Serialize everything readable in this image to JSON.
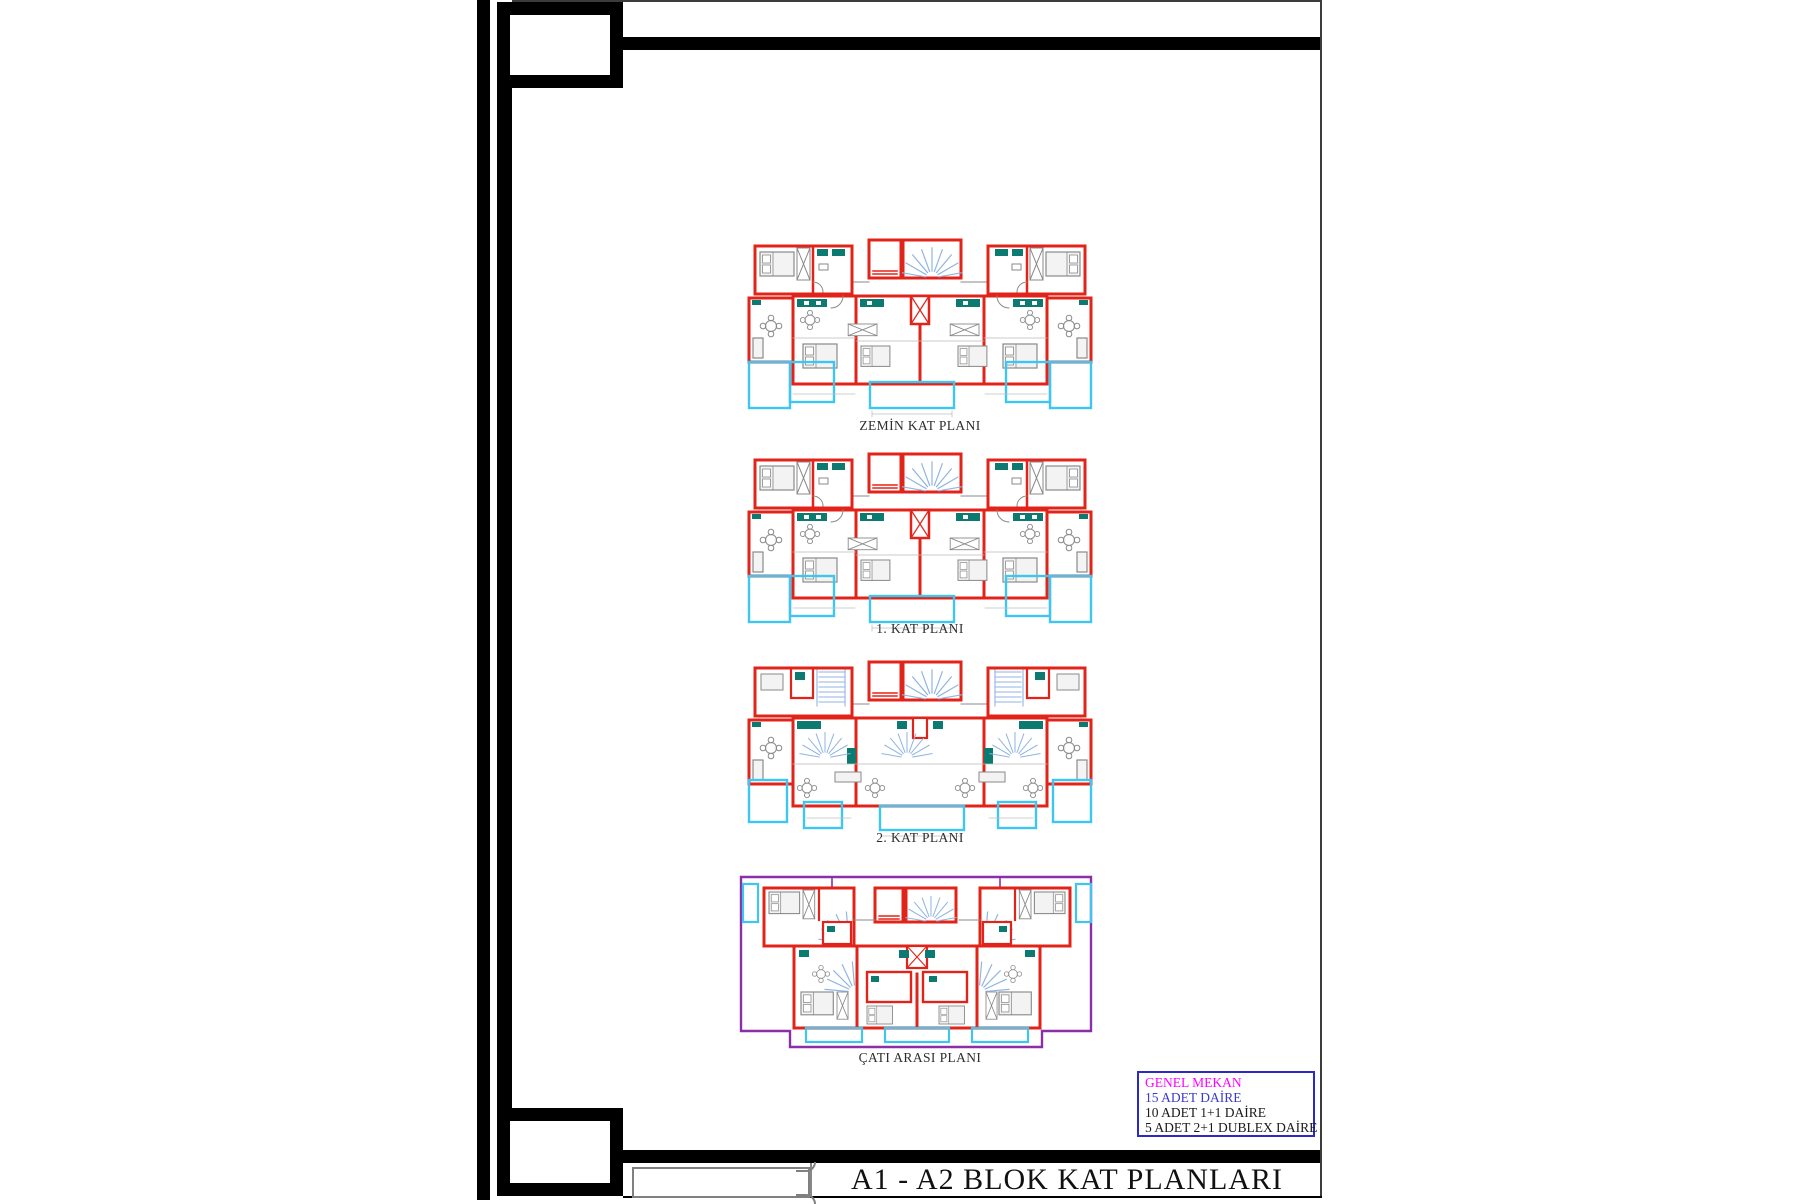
{
  "sheet": {
    "title": "A1 - A2 BLOK KAT PLANLARI"
  },
  "plans": [
    {
      "label": "ZEMİN KAT PLANI"
    },
    {
      "label": "1. KAT PLANI"
    },
    {
      "label": "2. KAT PLANI"
    },
    {
      "label": "ÇATI ARASI PLANI"
    }
  ],
  "legend": {
    "title": "GENEL MEKAN",
    "title_color": "#ff00ff",
    "items": [
      {
        "text": "15 ADET DAİRE",
        "color": "#3a3ad0"
      },
      {
        "text": "10 ADET 1+1 DAİRE",
        "color": "#1a1a1a"
      },
      {
        "text": "5 ADET 2+1 DUBLEX DAİRE",
        "color": "#1a1a1a"
      }
    ]
  },
  "colors": {
    "wall_red": "#e2231a",
    "balcony_cyan": "#3fc6f0",
    "stair_blue": "#8fb5e3",
    "fixture_teal": "#0c7a70",
    "roof_purple": "#8b2fa8",
    "frame_black": "#000000"
  }
}
